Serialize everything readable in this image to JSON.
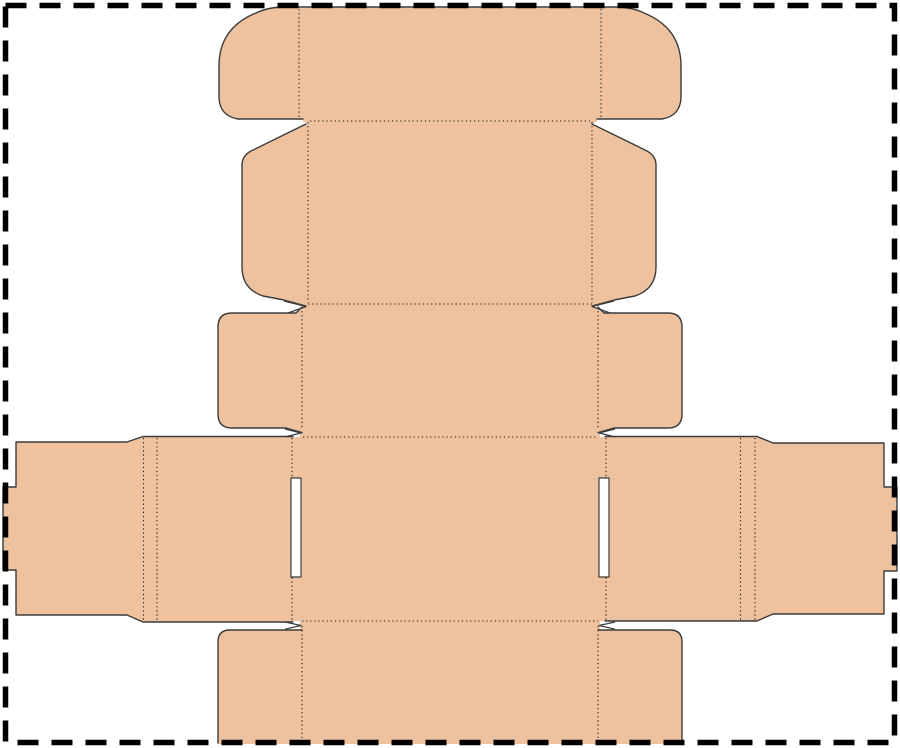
{
  "canvas": {
    "width": 900,
    "height": 748,
    "background": "#ffffff"
  },
  "palette": {
    "board_fill": "#eec29e",
    "cut_line": "#3c3c3c",
    "fold_line": "#222222",
    "slit_fill": "#ffffff",
    "border_line": "#000000"
  },
  "border": {
    "x": 5.5,
    "y": 5.5,
    "width": 889,
    "height": 737,
    "thickness": 5.5,
    "dash": "21 13"
  },
  "dieline": {
    "fills": [
      {
        "name": "tuck-flap-fill",
        "d": "M 303,122 L 303,119 L 238,119 Q 220,116 219,98 L 219,66 Q 219,28 256,13 Q 268,7 285,7 L 615,7 Q 632,7 644,13 Q 681,28 681,66 L 681,98 Q 680,116 662,119 L 597,119 L 597,122 Z"
      },
      {
        "name": "lid-top-panel-fill",
        "d": "M 306,121 L 594,121 L 594,304 L 306,304 Z"
      },
      {
        "name": "lid-left-dust-flap-fill",
        "d": "M 306,124 L 253,150 Q 242,155 242,165 L 242,267 Q 242,289 263,296 L 284,300 L 306,306 Z"
      },
      {
        "name": "lid-right-dust-flap-fill",
        "d": "M 592,124 L 645,150 Q 656,155 656,165 L 656,267 Q 656,289 635,296 L 614,300 L 592,306 Z"
      },
      {
        "name": "front-panel-fill",
        "d": "M 300,304 L 600,304 L 600,437 L 300,437 Z"
      },
      {
        "name": "front-left-flap-fill",
        "d": "M 302,307 L 296,313 L 232,313 Q 218,313 218,327 L 218,414 Q 218,428 232,428 L 286,428 L 302,432.5 Z"
      },
      {
        "name": "front-right-flap-fill",
        "d": "M 598,307 L 604,313 L 668,313 Q 682,313 682,327 L 682,414 Q 682,428 668,428 L 614,428 L 598,432.5 Z"
      },
      {
        "name": "base-panel-fill",
        "d": "M 292,437 L 606,437 L 606,621 L 292,621 Z"
      },
      {
        "name": "left-side-wing-fill",
        "d": "M 293,437 L 143,437 L 127,442 L 16,442 L 16,487 L 3,487 L 3,570 L 16,570 L 16,615 L 127,615 L 143,622 L 293,622 Z"
      },
      {
        "name": "right-side-wing-fill",
        "d": "M 605,437 L 757,437 L 773,443 L 884,443 L 884,487 L 897,487 L 897,571 L 884,571 L 884,614 L 773,614 L 757,621 L 605,621 Z"
      },
      {
        "name": "back-panel-fill",
        "d": "M 300,621 L 600,621 L 600,744 L 300,744 Z"
      },
      {
        "name": "back-left-flap-fill",
        "d": "M 302,630 L 230,630 Q 218,630 218,642 L 218,744 L 302,744 Z"
      },
      {
        "name": "back-right-flap-fill",
        "d": "M 598,630 L 670,630 Q 682,630 682,642 L 682,744 L 598,744 Z"
      }
    ],
    "folds": [
      {
        "name": "tuck-flap-left-crease",
        "x1": 299,
        "y1": 9,
        "x2": 299,
        "y2": 119
      },
      {
        "name": "tuck-flap-right-crease",
        "x1": 601,
        "y1": 9,
        "x2": 601,
        "y2": 119
      },
      {
        "name": "tuck-to-lid-crease",
        "x1": 310,
        "y1": 121,
        "x2": 590,
        "y2": 121
      },
      {
        "name": "lid-left-crease",
        "x1": 308,
        "y1": 122,
        "x2": 308,
        "y2": 303
      },
      {
        "name": "lid-right-crease",
        "x1": 592,
        "y1": 122,
        "x2": 592,
        "y2": 303
      },
      {
        "name": "lid-to-front-crease",
        "x1": 308,
        "y1": 304,
        "x2": 592,
        "y2": 304
      },
      {
        "name": "front-left-crease",
        "x1": 302,
        "y1": 307,
        "x2": 302,
        "y2": 430
      },
      {
        "name": "front-right-crease",
        "x1": 598,
        "y1": 307,
        "x2": 598,
        "y2": 430
      },
      {
        "name": "front-to-base-crease",
        "x1": 303,
        "y1": 437,
        "x2": 597,
        "y2": 437
      },
      {
        "name": "base-left-crease",
        "x1": 292,
        "y1": 438,
        "x2": 292,
        "y2": 620
      },
      {
        "name": "base-right-crease",
        "x1": 606,
        "y1": 438,
        "x2": 606,
        "y2": 620
      },
      {
        "name": "left-wing-double-crease-outer",
        "x1": 143.5,
        "y1": 438,
        "x2": 143.5,
        "y2": 621
      },
      {
        "name": "left-wing-double-crease-inner",
        "x1": 157,
        "y1": 438,
        "x2": 157,
        "y2": 621
      },
      {
        "name": "right-wing-double-crease-inner",
        "x1": 740.5,
        "y1": 438,
        "x2": 740.5,
        "y2": 620
      },
      {
        "name": "right-wing-double-crease-outer",
        "x1": 755,
        "y1": 438,
        "x2": 755,
        "y2": 620
      },
      {
        "name": "base-to-back-crease",
        "x1": 302,
        "y1": 621,
        "x2": 598,
        "y2": 621
      },
      {
        "name": "back-left-crease",
        "x1": 302,
        "y1": 626,
        "x2": 302,
        "y2": 742
      },
      {
        "name": "back-right-crease",
        "x1": 598,
        "y1": 626,
        "x2": 598,
        "y2": 742
      }
    ],
    "slits": [
      {
        "name": "left-lock-slot",
        "d": "M 291,478 L 301,478 L 301,577 L 291,577 Z",
        "closed": true
      },
      {
        "name": "right-lock-slot",
        "d": "M 599,478 L 609,478 L 609,577 L 599,577 Z",
        "closed": true
      },
      {
        "name": "upper-left-notch",
        "d": "M 284,301 L 306,306.5 L 288,313",
        "closed": false
      },
      {
        "name": "upper-right-notch",
        "d": "M 614,301 L 592,306.5 L 610,313",
        "closed": false
      },
      {
        "name": "mid-left-slit-tip",
        "d": "M 285,429 L 301,433 L 285,436.8",
        "closed": false
      },
      {
        "name": "mid-right-slit-tip",
        "d": "M 615,429 L 599,433 L 615,436.8",
        "closed": false
      },
      {
        "name": "lower-left-slit-tip",
        "d": "M 285,622 L 301,625.5 L 285,629.2",
        "closed": false
      },
      {
        "name": "lower-right-slit-tip",
        "d": "M 615,622 L 599,625.5 L 615,629.2",
        "closed": false
      }
    ],
    "cuts": [
      {
        "name": "tuck-flap-cut",
        "d": "M 303,119 L 238,119 Q 220,116 219,98 L 219,66 Q 219,28 256,13 Q 268,7 285,7 L 615,7 Q 632,7 644,13 Q 681,28 681,66 L 681,98 Q 680,116 662,119 L 597,119"
      },
      {
        "name": "lid-left-dust-flap-cut",
        "d": "M 306,124 L 253,150 Q 242,155 242,165 L 242,267 Q 242,289 263,296 L 284,300 L 306,306"
      },
      {
        "name": "lid-right-dust-flap-cut",
        "d": "M 592,124 L 645,150 Q 656,155 656,165 L 656,267 Q 656,289 635,296 L 614,300 L 592,306"
      },
      {
        "name": "front-left-flap-cut",
        "d": "M 302,307 L 296,313 L 232,313 Q 218,313 218,327 L 218,414 Q 218,428 232,428 L 286,428 L 302,432.5"
      },
      {
        "name": "front-right-flap-cut",
        "d": "M 598,307 L 604,313 L 668,313 Q 682,313 682,327 L 682,414 Q 682,428 668,428 L 614,428 L 598,432.5"
      },
      {
        "name": "left-side-wing-cut",
        "d": "M 293,436.5 L 143,436.5 L 127,442 L 16,442 L 16,487 L 3,487 L 3,570 L 16,570 L 16,615 L 127,615 L 143,622 L 293,622"
      },
      {
        "name": "right-side-wing-cut",
        "d": "M 605,436.5 L 757,436.5 L 773,443 L 884,443 L 884,487 L 897,487 L 897,571 L 884,571 L 884,614 L 773,614 L 757,621 L 605,621"
      },
      {
        "name": "back-left-flap-cut",
        "d": "M 302,630 L 230,630 Q 218,630 218,642 L 218,743"
      },
      {
        "name": "back-right-flap-cut",
        "d": "M 598,630 L 670,630 Q 682,630 682,642 L 682,743"
      }
    ]
  }
}
